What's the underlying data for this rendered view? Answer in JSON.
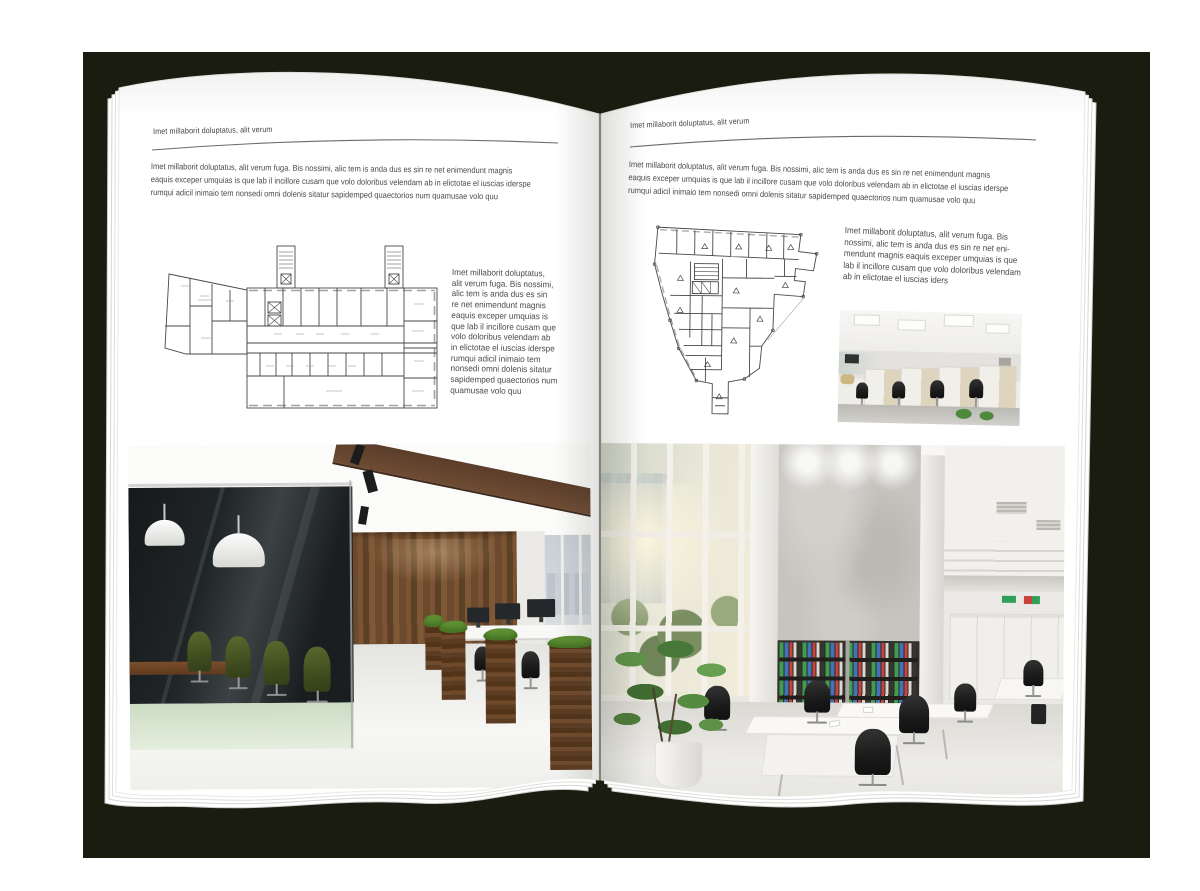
{
  "left_page": {
    "header": "Imet millaborit doluptatus, alit verum",
    "intro_lines": [
      "Imet millaborit doluptatus, alit verum fuga. Bis nossimi, alic tem is anda dus es sin re net enimendunt magnis",
      "eaquis exceper umquias is que lab il incillore cusam que volo doloribus velendam ab in elictotae el iuscias iderspe",
      "rumqui adicil inimaio tem nonsedi omni dolenis sitatur sapidemped quaectorios num quamusae volo quu"
    ],
    "sidebar_lines": [
      "Imet millaborit doluptatus,",
      "alit verum fuga. Bis nossimi,",
      "alic tem is anda dus es sin",
      "re net enimendunt magnis",
      "eaquis exceper umquias is",
      "que lab il incillore cusam que",
      "volo doloribus velendam ab",
      "in elictotae el iuscias iderspe",
      "rumqui adicil inimaio tem",
      "nonsedi omni dolenis sitatur",
      "sapidemped quaectorios num",
      "quamusae volo quu"
    ]
  },
  "right_page": {
    "header": "Imet millaborit doluptatus, alit verum",
    "intro_lines": [
      "Imet millaborit doluptatus, alit verum fuga. Bis nossimi, alic tem is anda dus es sin re net enimendunt magnis",
      "eaquis exceper umquias is que lab il incillore cusam que volo doloribus velendam ab in elictotae el iuscias iderspe",
      "rumqui adicil inimaio tem nonsedi omni dolenis sitatur sapidemped quaectorios num quamusae volo quu"
    ],
    "callout_lines": [
      "Imet millaborit doluptatus, alit verum fuga. Bis",
      "nossimi, alic tem is anda dus es sin re net eni-",
      "mendunt magnis eaquis exceper umquias is que",
      "lab il incillore cusam que volo doloribus velendam",
      "ab in elictotae el iuscias iders"
    ]
  },
  "colors": {
    "backdrop": "#1b1c10",
    "page": "#ffffff",
    "text": "#4a4a4a",
    "rule": "#6a6a6a",
    "plan_line": "#474747",
    "wood": "#6f4c2e",
    "grass": "#5d9033",
    "binder_green": "#3f9d4e",
    "binder_blue": "#4273b5",
    "binder_red": "#c8433e"
  }
}
